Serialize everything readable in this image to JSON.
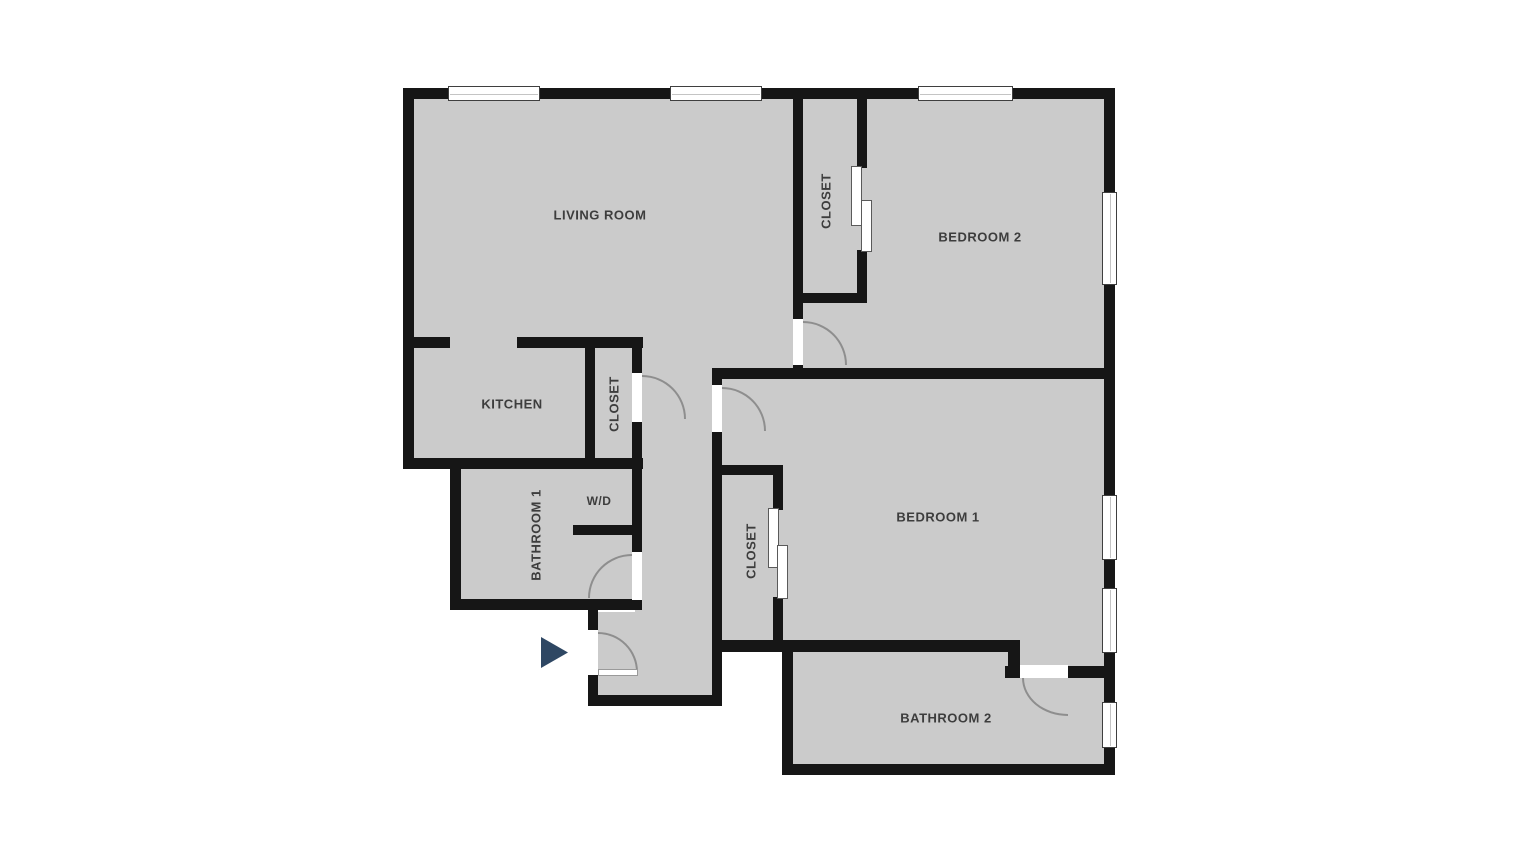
{
  "rooms": [
    {
      "name": "living-room",
      "label": "LIVING ROOM",
      "label_orientation": "horizontal"
    },
    {
      "name": "kitchen",
      "label": "KITCHEN",
      "label_orientation": "horizontal"
    },
    {
      "name": "kitchen-closet",
      "label": "CLOSET",
      "label_orientation": "vertical"
    },
    {
      "name": "bathroom-1",
      "label": "BATHROOM 1",
      "label_orientation": "vertical"
    },
    {
      "name": "washer-dryer",
      "label": "W/D",
      "label_orientation": "horizontal"
    },
    {
      "name": "bedroom-2-closet",
      "label": "CLOSET",
      "label_orientation": "vertical"
    },
    {
      "name": "bedroom-2",
      "label": "BEDROOM 2",
      "label_orientation": "horizontal"
    },
    {
      "name": "bedroom-1",
      "label": "BEDROOM 1",
      "label_orientation": "horizontal"
    },
    {
      "name": "bedroom-1-closet",
      "label": "CLOSET",
      "label_orientation": "vertical"
    },
    {
      "name": "bathroom-2",
      "label": "BATHROOM 2",
      "label_orientation": "horizontal"
    }
  ],
  "entry": {
    "marker": "triangle-arrow",
    "direction": "right"
  },
  "colors": {
    "background": "#ffffff",
    "floor": "#cbcbcb",
    "wall": "#161616",
    "door_arc": "#8e8e8e",
    "window_border": "#3f3f3f",
    "label_text": "#3d3d3d",
    "entry_arrow": "#2e4763"
  }
}
